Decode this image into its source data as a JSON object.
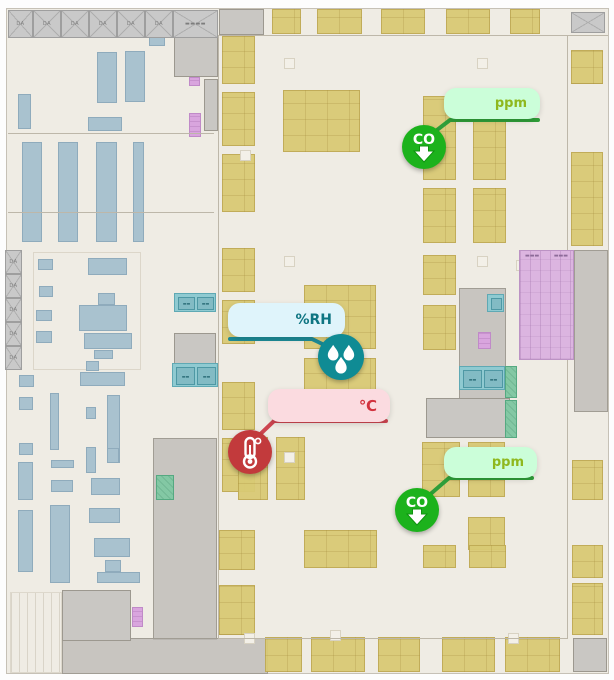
{
  "palette": {
    "floor_bg": "#EFECE4",
    "wall": "#BDB7A9",
    "rack_yellow": "#D8C974",
    "equipment_blue": "#A9C2CF",
    "room_gray": "#C9C7C3",
    "room_teal": "#8FCAD1",
    "room_green": "#83C8A4",
    "ramp_purple": "#DCB5E0",
    "co_green": "#1CB21C",
    "co_line": "#2F9E39",
    "co_tooltip_bg": "#CBFED9",
    "co_text": "#8FB81E",
    "rh_teal": "#0F8B94",
    "rh_line": "#1D8A96",
    "rh_tooltip_bg": "#DFF4FB",
    "rh_text": "#0E7582",
    "temp_red": "#C23A3C",
    "temp_line": "#CD4550",
    "temp_tooltip_bg": "#FBDBE0",
    "temp_text": "#D2333F"
  },
  "floorplan": {
    "truss_top": {
      "y": 10,
      "h": 28,
      "cells": [
        {
          "x": 8,
          "w": 25,
          "label": "DA"
        },
        {
          "x": 33,
          "w": 28,
          "label": "DA"
        },
        {
          "x": 61,
          "w": 28,
          "label": "DA"
        },
        {
          "x": 89,
          "w": 28,
          "label": "DA"
        },
        {
          "x": 117,
          "w": 28,
          "label": "DA"
        },
        {
          "x": 145,
          "w": 28,
          "label": "DA"
        },
        {
          "x": 173,
          "w": 45,
          "label": "▬▬▬▬"
        }
      ]
    },
    "truss_left": {
      "x": 5,
      "w": 17,
      "cells": [
        {
          "y": 250,
          "h": 24,
          "label": "DA"
        },
        {
          "y": 274,
          "h": 24,
          "label": "DA"
        },
        {
          "y": 298,
          "h": 24,
          "label": "DA"
        },
        {
          "y": 322,
          "h": 24,
          "label": "DA"
        },
        {
          "y": 346,
          "h": 24,
          "label": "DA"
        }
      ]
    },
    "ramp": {
      "x": 519,
      "y": 250,
      "w": 55,
      "h": 110,
      "labels": [
        "▬▬▬",
        "▬▬▬"
      ]
    },
    "rects": [
      {
        "t": "hatch",
        "x": 10,
        "y": 592,
        "w": 52,
        "h": 81
      },
      {
        "t": "outline",
        "x": 33,
        "y": 252,
        "w": 108,
        "h": 118
      },
      {
        "t": "gz",
        "x": 459,
        "y": 288,
        "w": 47,
        "h": 112
      },
      {
        "t": "gz",
        "x": 574,
        "y": 250,
        "w": 34,
        "h": 162
      },
      {
        "t": "gz",
        "x": 153,
        "y": 438,
        "w": 64,
        "h": 202
      },
      {
        "t": "gz",
        "x": 62,
        "y": 638,
        "w": 206,
        "h": 36
      },
      {
        "t": "gr",
        "x": 174,
        "y": 31,
        "w": 44,
        "h": 46
      },
      {
        "t": "gr",
        "x": 204,
        "y": 79,
        "w": 14,
        "h": 52
      },
      {
        "t": "gr",
        "x": 219,
        "y": 9,
        "w": 45,
        "h": 26
      },
      {
        "t": "gr",
        "x": 426,
        "y": 398,
        "w": 84,
        "h": 40
      },
      {
        "t": "gr",
        "x": 62,
        "y": 590,
        "w": 69,
        "h": 51
      },
      {
        "t": "gr",
        "x": 573,
        "y": 638,
        "w": 34,
        "h": 34
      },
      {
        "t": "gr",
        "x": 174,
        "y": 333,
        "w": 42,
        "h": 33
      },
      {
        "t": "cellx",
        "x": 571,
        "y": 12,
        "w": 34,
        "h": 21
      },
      {
        "t": "tealb",
        "x": 174,
        "y": 293,
        "w": 42,
        "h": 19
      },
      {
        "t": "tealb",
        "x": 172,
        "y": 363,
        "w": 46,
        "h": 24
      },
      {
        "t": "tealb",
        "x": 459,
        "y": 366,
        "w": 46,
        "h": 24
      },
      {
        "t": "tealsq",
        "x": 487,
        "y": 294,
        "w": 17,
        "h": 18
      },
      {
        "t": "green",
        "x": 505,
        "y": 366,
        "w": 12,
        "h": 32
      },
      {
        "t": "green",
        "x": 505,
        "y": 400,
        "w": 12,
        "h": 38
      },
      {
        "t": "green",
        "x": 156,
        "y": 475,
        "w": 18,
        "h": 25
      },
      {
        "t": "pur",
        "x": 189,
        "y": 77,
        "w": 11,
        "h": 9
      },
      {
        "t": "pur",
        "x": 189,
        "y": 113,
        "w": 12,
        "h": 24
      },
      {
        "t": "pur",
        "x": 478,
        "y": 332,
        "w": 13,
        "h": 17
      },
      {
        "t": "pur",
        "x": 132,
        "y": 607,
        "w": 11,
        "h": 20
      },
      {
        "t": "blue",
        "x": 149,
        "y": 37,
        "w": 16,
        "h": 9
      },
      {
        "t": "blue",
        "x": 97,
        "y": 52,
        "w": 20,
        "h": 51
      },
      {
        "t": "blue",
        "x": 125,
        "y": 51,
        "w": 20,
        "h": 51
      },
      {
        "t": "blue",
        "x": 18,
        "y": 94,
        "w": 13,
        "h": 35
      },
      {
        "t": "blue",
        "x": 88,
        "y": 117,
        "w": 34,
        "h": 14
      },
      {
        "t": "blue",
        "x": 22,
        "y": 142,
        "w": 20,
        "h": 100
      },
      {
        "t": "blue",
        "x": 58,
        "y": 142,
        "w": 20,
        "h": 100
      },
      {
        "t": "blue",
        "x": 96,
        "y": 142,
        "w": 21,
        "h": 100
      },
      {
        "t": "blue",
        "x": 133,
        "y": 142,
        "w": 11,
        "h": 100
      },
      {
        "t": "blue",
        "x": 38,
        "y": 259,
        "w": 15,
        "h": 11
      },
      {
        "t": "blue",
        "x": 88,
        "y": 258,
        "w": 39,
        "h": 17
      },
      {
        "t": "blue",
        "x": 39,
        "y": 286,
        "w": 14,
        "h": 11
      },
      {
        "t": "blue",
        "x": 36,
        "y": 310,
        "w": 16,
        "h": 11
      },
      {
        "t": "blue",
        "x": 36,
        "y": 331,
        "w": 16,
        "h": 12
      },
      {
        "t": "blue",
        "x": 98,
        "y": 293,
        "w": 17,
        "h": 12
      },
      {
        "t": "blue",
        "x": 79,
        "y": 305,
        "w": 48,
        "h": 26
      },
      {
        "t": "blue",
        "x": 84,
        "y": 333,
        "w": 48,
        "h": 16
      },
      {
        "t": "blue",
        "x": 94,
        "y": 350,
        "w": 19,
        "h": 9
      },
      {
        "t": "blue",
        "x": 86,
        "y": 361,
        "w": 13,
        "h": 10
      },
      {
        "t": "blue",
        "x": 80,
        "y": 372,
        "w": 45,
        "h": 14
      },
      {
        "t": "blue",
        "x": 19,
        "y": 375,
        "w": 15,
        "h": 12
      },
      {
        "t": "blue",
        "x": 19,
        "y": 397,
        "w": 14,
        "h": 13
      },
      {
        "t": "blue",
        "x": 50,
        "y": 393,
        "w": 9,
        "h": 57
      },
      {
        "t": "blue",
        "x": 107,
        "y": 395,
        "w": 13,
        "h": 68
      },
      {
        "t": "blue",
        "x": 86,
        "y": 407,
        "w": 10,
        "h": 12
      },
      {
        "t": "blue",
        "x": 19,
        "y": 443,
        "w": 14,
        "h": 12
      },
      {
        "t": "blue",
        "x": 86,
        "y": 447,
        "w": 10,
        "h": 26
      },
      {
        "t": "blue",
        "x": 107,
        "y": 448,
        "w": 12,
        "h": 15
      },
      {
        "t": "blue",
        "x": 51,
        "y": 460,
        "w": 23,
        "h": 8
      },
      {
        "t": "blue",
        "x": 51,
        "y": 480,
        "w": 22,
        "h": 12
      },
      {
        "t": "blue",
        "x": 91,
        "y": 478,
        "w": 29,
        "h": 17
      },
      {
        "t": "blue",
        "x": 18,
        "y": 462,
        "w": 15,
        "h": 38
      },
      {
        "t": "blue",
        "x": 89,
        "y": 508,
        "w": 31,
        "h": 15
      },
      {
        "t": "blue",
        "x": 18,
        "y": 510,
        "w": 15,
        "h": 62
      },
      {
        "t": "blue",
        "x": 50,
        "y": 505,
        "w": 20,
        "h": 78
      },
      {
        "t": "blue",
        "x": 94,
        "y": 538,
        "w": 36,
        "h": 19
      },
      {
        "t": "blue",
        "x": 105,
        "y": 560,
        "w": 16,
        "h": 12
      },
      {
        "t": "blue",
        "x": 97,
        "y": 572,
        "w": 43,
        "h": 11
      },
      {
        "t": "yellow",
        "x": 272,
        "y": 9,
        "w": 29,
        "h": 25
      },
      {
        "t": "yellow",
        "x": 317,
        "y": 9,
        "w": 45,
        "h": 25
      },
      {
        "t": "yellow",
        "x": 381,
        "y": 9,
        "w": 44,
        "h": 25
      },
      {
        "t": "yellow",
        "x": 446,
        "y": 9,
        "w": 44,
        "h": 25
      },
      {
        "t": "yellow",
        "x": 510,
        "y": 9,
        "w": 30,
        "h": 25
      },
      {
        "t": "yellow",
        "x": 222,
        "y": 36,
        "w": 33,
        "h": 48
      },
      {
        "t": "yellow",
        "x": 222,
        "y": 92,
        "w": 33,
        "h": 54
      },
      {
        "t": "yellow",
        "x": 222,
        "y": 154,
        "w": 33,
        "h": 58
      },
      {
        "t": "yellow",
        "x": 222,
        "y": 248,
        "w": 33,
        "h": 44
      },
      {
        "t": "yellow",
        "x": 222,
        "y": 300,
        "w": 33,
        "h": 44
      },
      {
        "t": "yellow",
        "x": 222,
        "y": 382,
        "w": 33,
        "h": 48
      },
      {
        "t": "yellow",
        "x": 222,
        "y": 438,
        "w": 33,
        "h": 54
      },
      {
        "t": "yellow",
        "x": 219,
        "y": 530,
        "w": 36,
        "h": 40
      },
      {
        "t": "yellow",
        "x": 219,
        "y": 585,
        "w": 36,
        "h": 50
      },
      {
        "t": "yellow",
        "x": 283,
        "y": 90,
        "w": 77,
        "h": 62
      },
      {
        "t": "yellow",
        "x": 304,
        "y": 285,
        "w": 72,
        "h": 64
      },
      {
        "t": "yellow",
        "x": 304,
        "y": 358,
        "w": 72,
        "h": 64
      },
      {
        "t": "yellow",
        "x": 304,
        "y": 530,
        "w": 73,
        "h": 38
      },
      {
        "t": "yellow",
        "x": 238,
        "y": 437,
        "w": 30,
        "h": 63
      },
      {
        "t": "yellow",
        "x": 276,
        "y": 437,
        "w": 29,
        "h": 63
      },
      {
        "t": "yellow",
        "x": 423,
        "y": 96,
        "w": 33,
        "h": 84
      },
      {
        "t": "yellow",
        "x": 473,
        "y": 96,
        "w": 33,
        "h": 84
      },
      {
        "t": "yellow",
        "x": 423,
        "y": 188,
        "w": 33,
        "h": 55
      },
      {
        "t": "yellow",
        "x": 473,
        "y": 188,
        "w": 33,
        "h": 55
      },
      {
        "t": "yellow",
        "x": 423,
        "y": 255,
        "w": 33,
        "h": 40
      },
      {
        "t": "yellow",
        "x": 423,
        "y": 305,
        "w": 33,
        "h": 45
      },
      {
        "t": "yellow",
        "x": 422,
        "y": 442,
        "w": 38,
        "h": 55
      },
      {
        "t": "yellow",
        "x": 468,
        "y": 442,
        "w": 37,
        "h": 55
      },
      {
        "t": "yellow",
        "x": 468,
        "y": 517,
        "w": 37,
        "h": 33
      },
      {
        "t": "yellow",
        "x": 423,
        "y": 545,
        "w": 33,
        "h": 23
      },
      {
        "t": "yellow",
        "x": 469,
        "y": 545,
        "w": 37,
        "h": 23
      },
      {
        "t": "yellow",
        "x": 571,
        "y": 50,
        "w": 32,
        "h": 34
      },
      {
        "t": "yellow",
        "x": 571,
        "y": 152,
        "w": 32,
        "h": 94
      },
      {
        "t": "yellow",
        "x": 572,
        "y": 460,
        "w": 31,
        "h": 40
      },
      {
        "t": "yellow",
        "x": 572,
        "y": 545,
        "w": 31,
        "h": 33
      },
      {
        "t": "yellow",
        "x": 572,
        "y": 583,
        "w": 31,
        "h": 52
      },
      {
        "t": "yellow",
        "x": 265,
        "y": 637,
        "w": 37,
        "h": 35
      },
      {
        "t": "yellow",
        "x": 311,
        "y": 637,
        "w": 54,
        "h": 35
      },
      {
        "t": "yellow",
        "x": 378,
        "y": 637,
        "w": 42,
        "h": 35
      },
      {
        "t": "yellow",
        "x": 442,
        "y": 637,
        "w": 53,
        "h": 35
      },
      {
        "t": "yellow",
        "x": 505,
        "y": 637,
        "w": 55,
        "h": 35
      },
      {
        "t": "pad",
        "x": 284,
        "y": 58,
        "w": 11,
        "h": 11
      },
      {
        "t": "pad",
        "x": 284,
        "y": 256,
        "w": 11,
        "h": 11
      },
      {
        "t": "pad",
        "x": 477,
        "y": 58,
        "w": 11,
        "h": 11
      },
      {
        "t": "pad",
        "x": 477,
        "y": 256,
        "w": 11,
        "h": 11
      },
      {
        "t": "pad",
        "x": 284,
        "y": 452,
        "w": 11,
        "h": 11
      },
      {
        "t": "pad",
        "x": 516,
        "y": 260,
        "w": 11,
        "h": 11
      },
      {
        "t": "pad",
        "x": 240,
        "y": 150,
        "w": 11,
        "h": 11
      },
      {
        "t": "pad",
        "x": 244,
        "y": 633,
        "w": 11,
        "h": 11
      },
      {
        "t": "pad",
        "x": 330,
        "y": 630,
        "w": 11,
        "h": 11
      },
      {
        "t": "pad",
        "x": 508,
        "y": 633,
        "w": 11,
        "h": 11
      }
    ],
    "walls": [
      {
        "x": 218,
        "y": 35,
        "w": 1,
        "h": 603
      },
      {
        "x": 567,
        "y": 35,
        "w": 1,
        "h": 603
      },
      {
        "x": 218,
        "y": 35,
        "w": 390,
        "h": 1
      },
      {
        "x": 8,
        "y": 133,
        "w": 206,
        "h": 1
      },
      {
        "x": 8,
        "y": 212,
        "w": 206,
        "h": 1
      },
      {
        "x": 218,
        "y": 638,
        "w": 350,
        "h": 1
      }
    ]
  },
  "sensors": [
    {
      "id": "co-sensor-1",
      "kind": "gas",
      "icon": "co-down-arrow",
      "label": "CO",
      "unit": "ppm",
      "circle": {
        "cx": 424,
        "cy": 147,
        "r": 22,
        "color": "#1CB21C"
      },
      "tooltip": {
        "x": 444,
        "y": 88,
        "w": 96,
        "h": 31,
        "bg": "#CBFED9",
        "text_color": "#8FB81E",
        "font": 13
      },
      "line": {
        "color": "#2F9E39",
        "points": [
          [
            538,
            120
          ],
          [
            450,
            120
          ],
          [
            424,
            140
          ]
        ]
      }
    },
    {
      "id": "humidity-sensor",
      "kind": "humidity",
      "icon": "water-drops",
      "label": "",
      "unit": "%RH",
      "circle": {
        "cx": 341,
        "cy": 357,
        "r": 23,
        "color": "#0F8B94"
      },
      "tooltip": {
        "x": 228,
        "y": 303,
        "w": 117,
        "h": 34,
        "bg": "#DFF4FB",
        "text_color": "#0E7582",
        "font": 14
      },
      "line": {
        "color": "#1D8A96",
        "points": [
          [
            230,
            339
          ],
          [
            312,
            339
          ],
          [
            341,
            353
          ]
        ]
      }
    },
    {
      "id": "temperature-sensor",
      "kind": "temperature",
      "icon": "thermometer",
      "label": "",
      "unit": "℃",
      "circle": {
        "cx": 250,
        "cy": 452,
        "r": 22,
        "color": "#C23A3C"
      },
      "tooltip": {
        "x": 268,
        "y": 389,
        "w": 122,
        "h": 33,
        "bg": "#FBDBE0",
        "text_color": "#D2333F",
        "font": 15
      },
      "line": {
        "color": "#CD4550",
        "points": [
          [
            386,
            421
          ],
          [
            274,
            421
          ],
          [
            252,
            442
          ]
        ]
      }
    },
    {
      "id": "co-sensor-2",
      "kind": "gas",
      "icon": "co-down-arrow",
      "label": "CO",
      "unit": "ppm",
      "circle": {
        "cx": 417,
        "cy": 510,
        "r": 22,
        "color": "#1CB21C"
      },
      "tooltip": {
        "x": 444,
        "y": 447,
        "w": 93,
        "h": 31,
        "bg": "#CBFED9",
        "text_color": "#8FB81E",
        "font": 13
      },
      "line": {
        "color": "#2F9E39",
        "points": [
          [
            532,
            478
          ],
          [
            449,
            478
          ],
          [
            419,
            504
          ]
        ]
      }
    }
  ]
}
